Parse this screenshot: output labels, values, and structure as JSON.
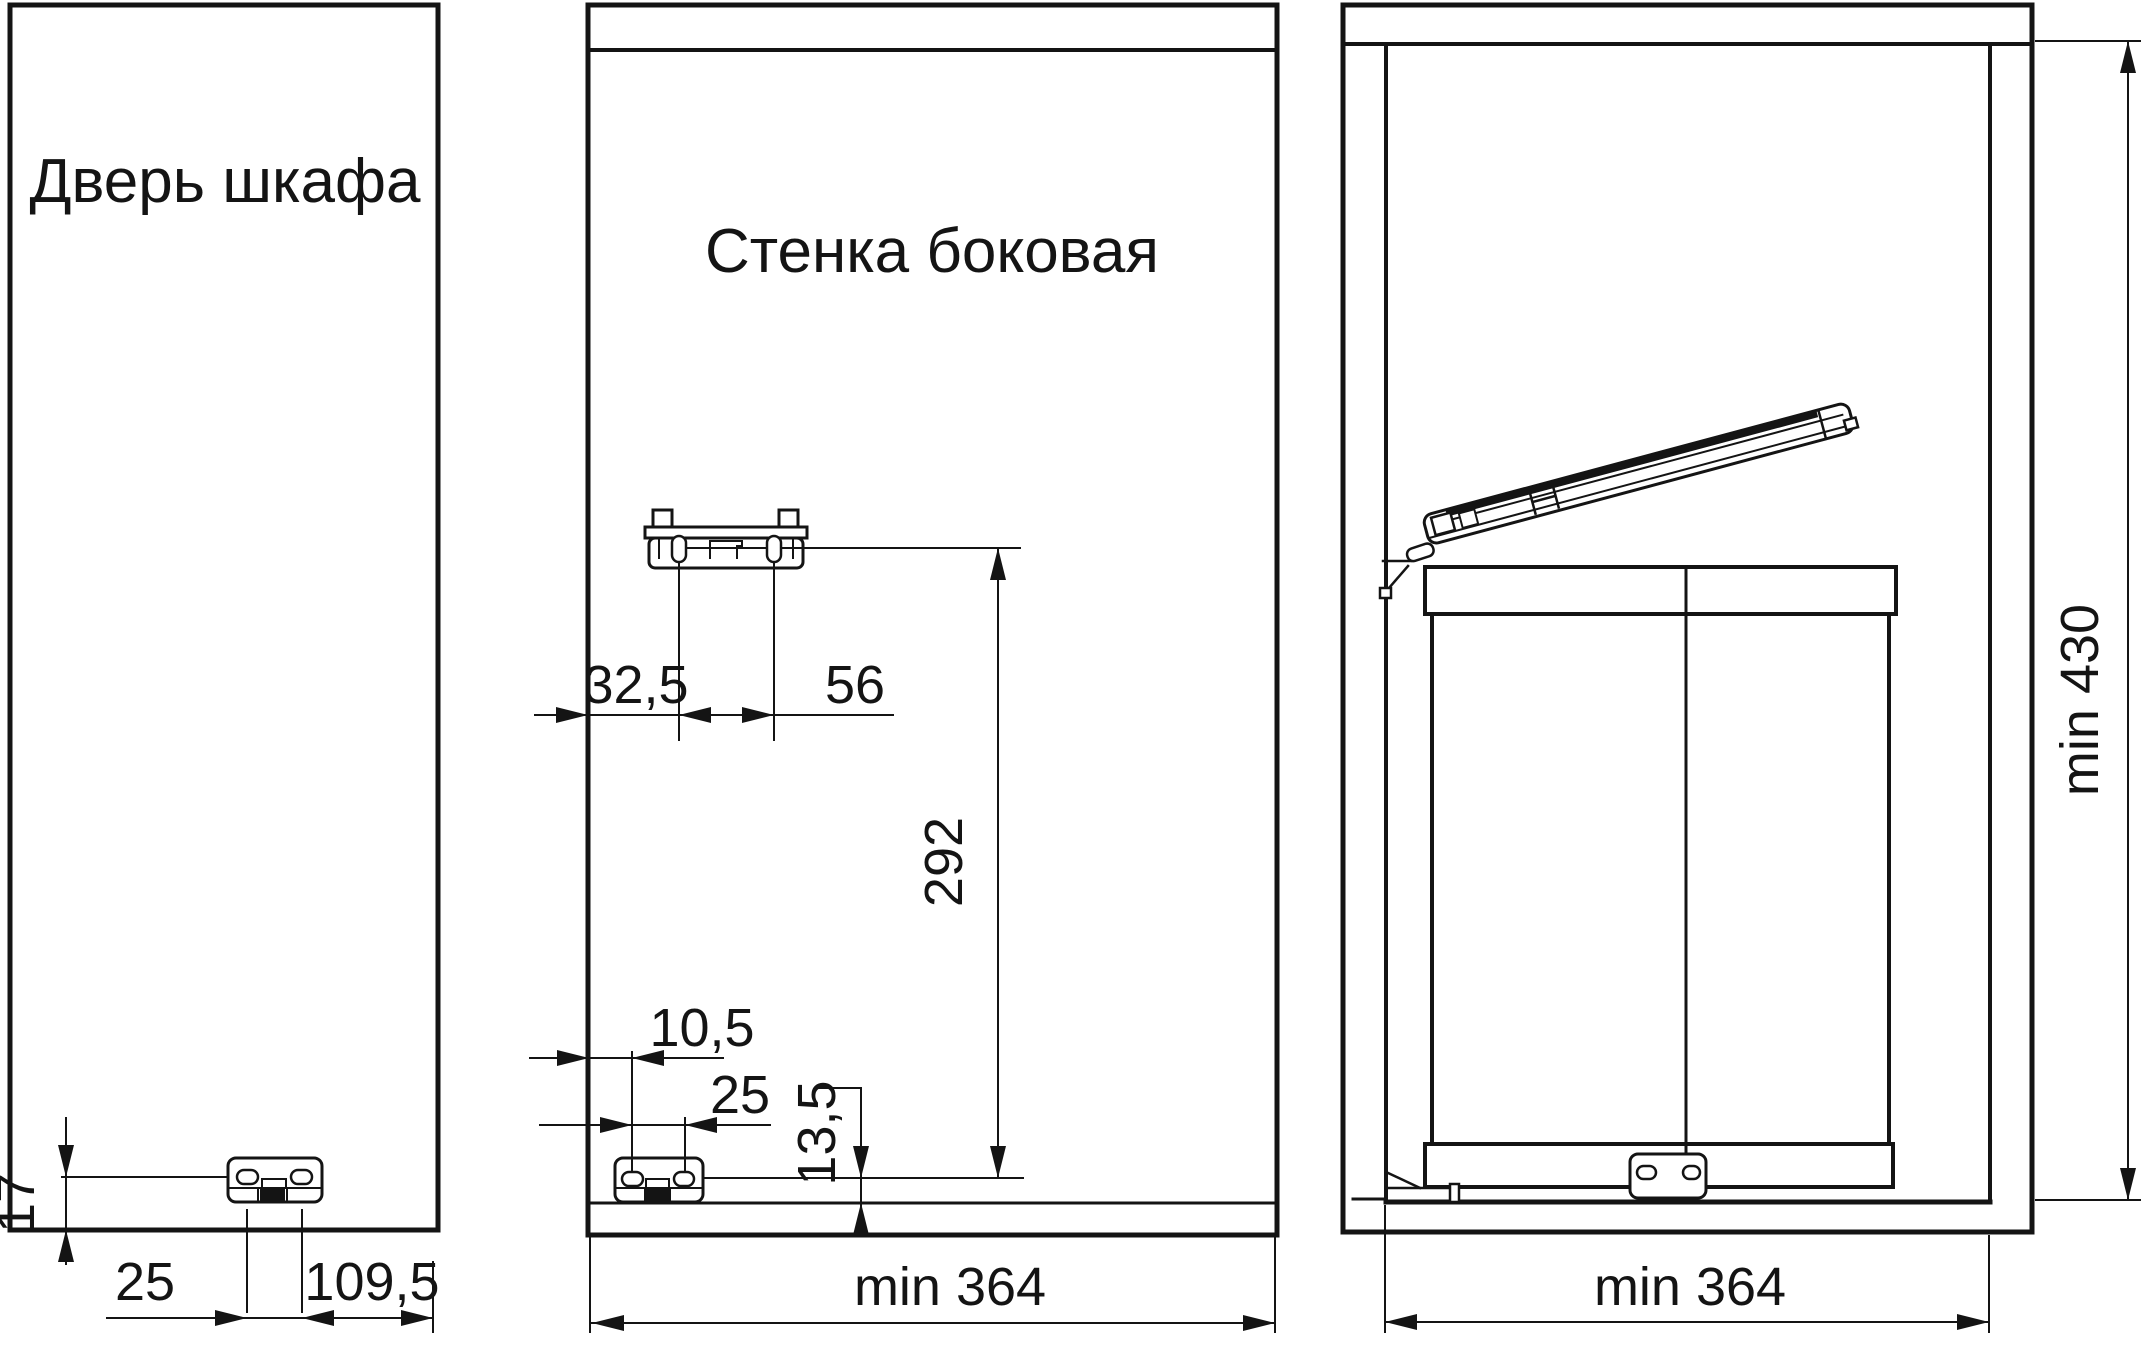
{
  "drawing": {
    "description": "furniture installation drawing, three views",
    "line_color": "#141414",
    "background": "#ffffff"
  },
  "door_panel": {
    "title": "Дверь шкафа",
    "dim_hole_line_to_bottom": "17",
    "dim_hole_spacing": "25",
    "dim_hole_to_edge": "109,5"
  },
  "side_wall_panel": {
    "title": "Стенка боковая",
    "dim_upper_edge_to_hole": "32,5",
    "dim_upper_hole_spacing": "56",
    "dim_vertical_between_brackets": "292",
    "dim_lower_edge_to_hole": "10,5",
    "dim_lower_hole_spacing": "25",
    "dim_hole_line_above_bottom": "13,5",
    "dim_min_depth": "min 364"
  },
  "cabinet_view": {
    "dim_min_inner_height": "min 430",
    "dim_min_inner_width": "min 364"
  }
}
